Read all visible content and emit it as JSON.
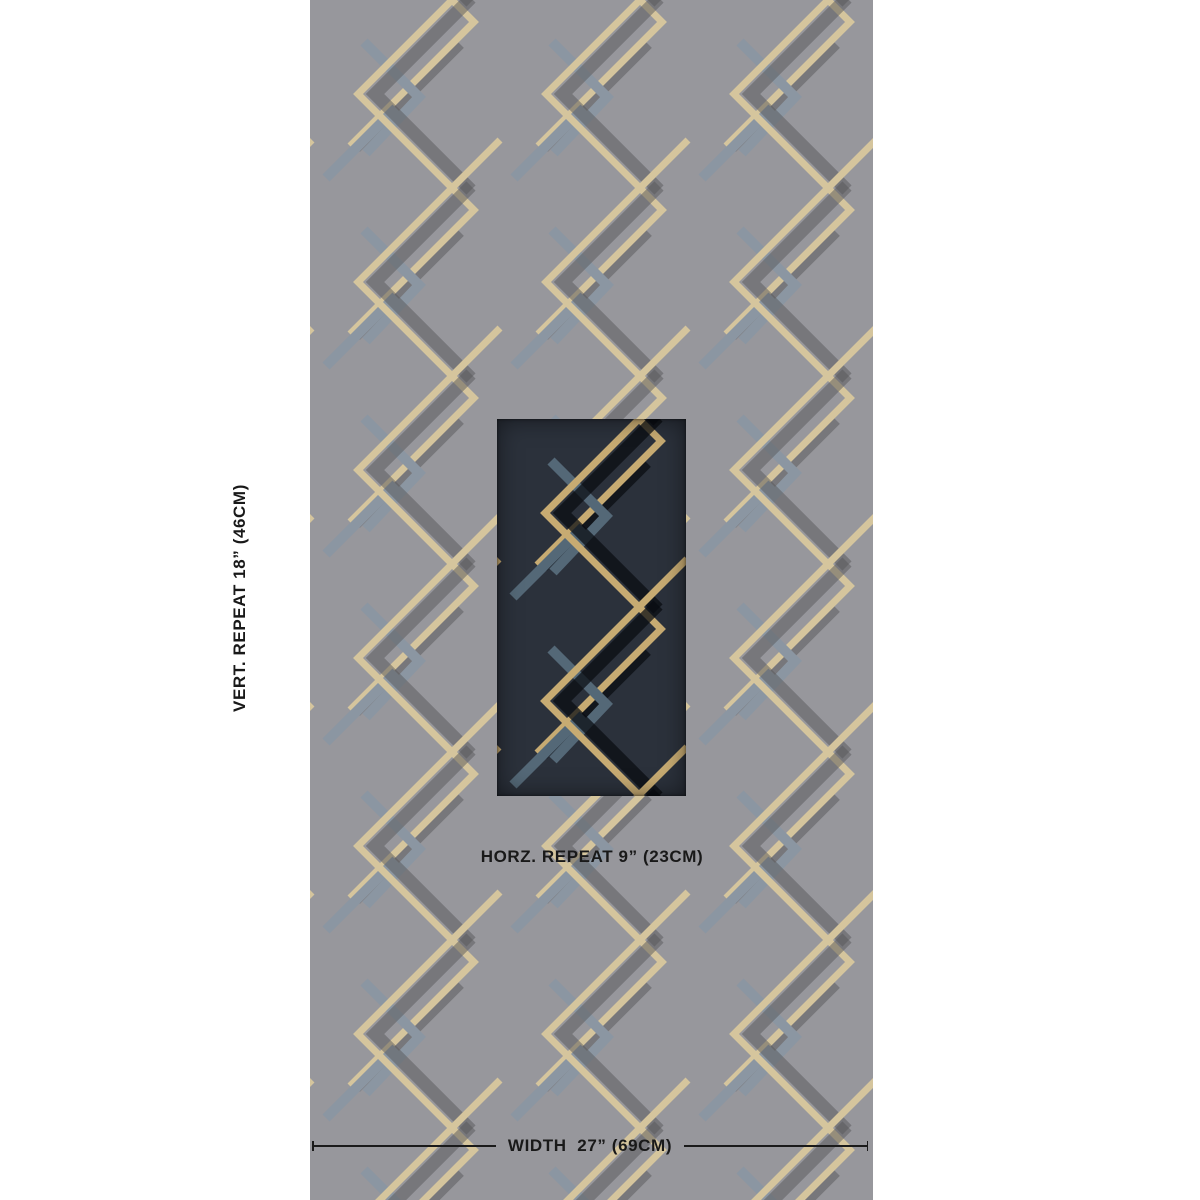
{
  "page": {
    "background": "#ffffff",
    "description": "Wallpaper product dimension preview"
  },
  "labels": {
    "vertical_repeat": "VERT. REPEAT 18” (46CM)",
    "horizontal_repeat": "HORZ. REPEAT 9” (23CM)",
    "width": "WIDTH  27” (69CM)"
  },
  "panel": {
    "background": "#97979c",
    "pattern_colors": {
      "gold": "#d5c59d",
      "blue_gray": "#8b96a2",
      "shadow": "rgba(88,88,90,0.5)"
    }
  },
  "swatch": {
    "background": "#2b313b",
    "pattern_colors": {
      "gold": "#c7ab72",
      "blue_gray": "#546877",
      "shadow": "rgba(8,11,16,0.72)"
    }
  },
  "measurement": {
    "line_color": "#1a1a1a"
  }
}
